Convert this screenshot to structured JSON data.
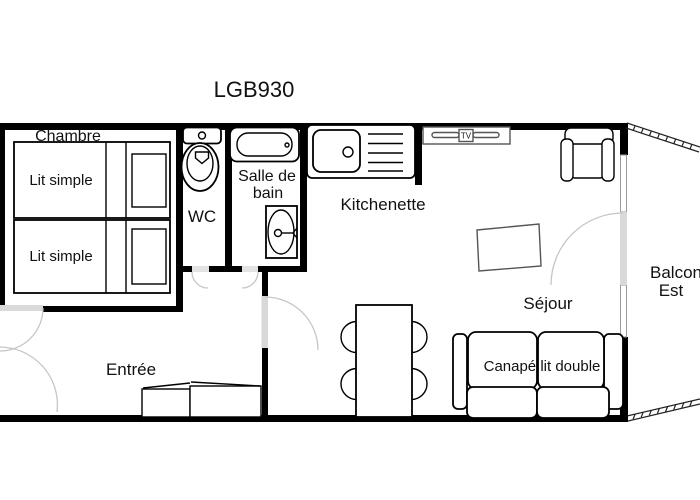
{
  "title": "LGB930",
  "rooms": {
    "chambre": "Chambre",
    "wc": "WC",
    "salle_de_bain_line1": "Salle de",
    "salle_de_bain_line2": "bain",
    "kitchenette": "Kitchenette",
    "sejour": "Séjour",
    "entree": "Entrée",
    "balcon_line1": "Balcon",
    "balcon_line2": "Est"
  },
  "furniture": {
    "bed1": "Lit simple",
    "bed2": "Lit simple",
    "sofa": "Canapé lit double",
    "tv": "TV"
  },
  "colors": {
    "wall": "#000000",
    "door_leaf": "#d9d9d9",
    "door_arc": "#c6c6c6",
    "furniture_stroke": "#000000",
    "detail_stroke": "#555555",
    "text": "#111111",
    "background": "#ffffff"
  }
}
